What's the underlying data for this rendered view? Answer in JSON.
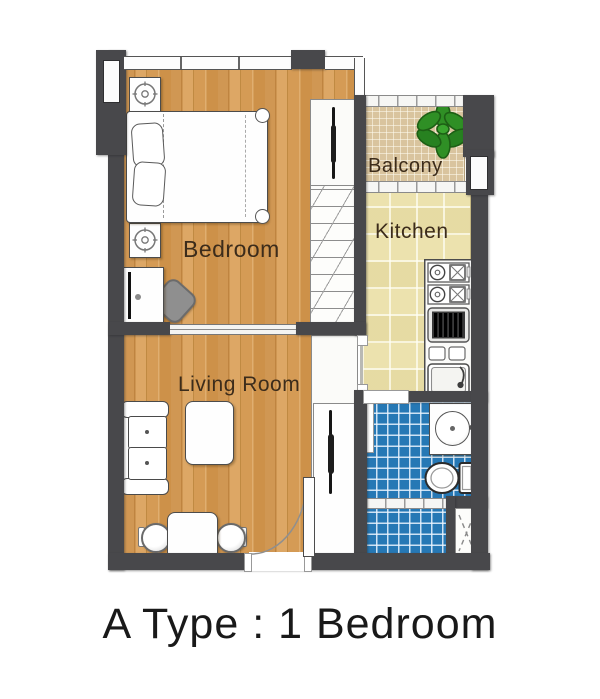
{
  "caption": {
    "text": "A Type : 1 Bedroom"
  },
  "rooms": {
    "bedroom": {
      "label": "Bedroom"
    },
    "living_room": {
      "label": "Living Room"
    },
    "kitchen": {
      "label": "Kitchen"
    },
    "balcony": {
      "label": "Balcony"
    }
  },
  "colors": {
    "wall": "#48484b",
    "wood_floor": "#d39b59",
    "kitchen_tile": "#ece2ae",
    "balcony_tile": "#d9c49e",
    "bathroom_tile": "#2678b5",
    "plant_green": "#2f8f25",
    "label_text": "#3c2c1b",
    "caption_text": "#191919"
  }
}
